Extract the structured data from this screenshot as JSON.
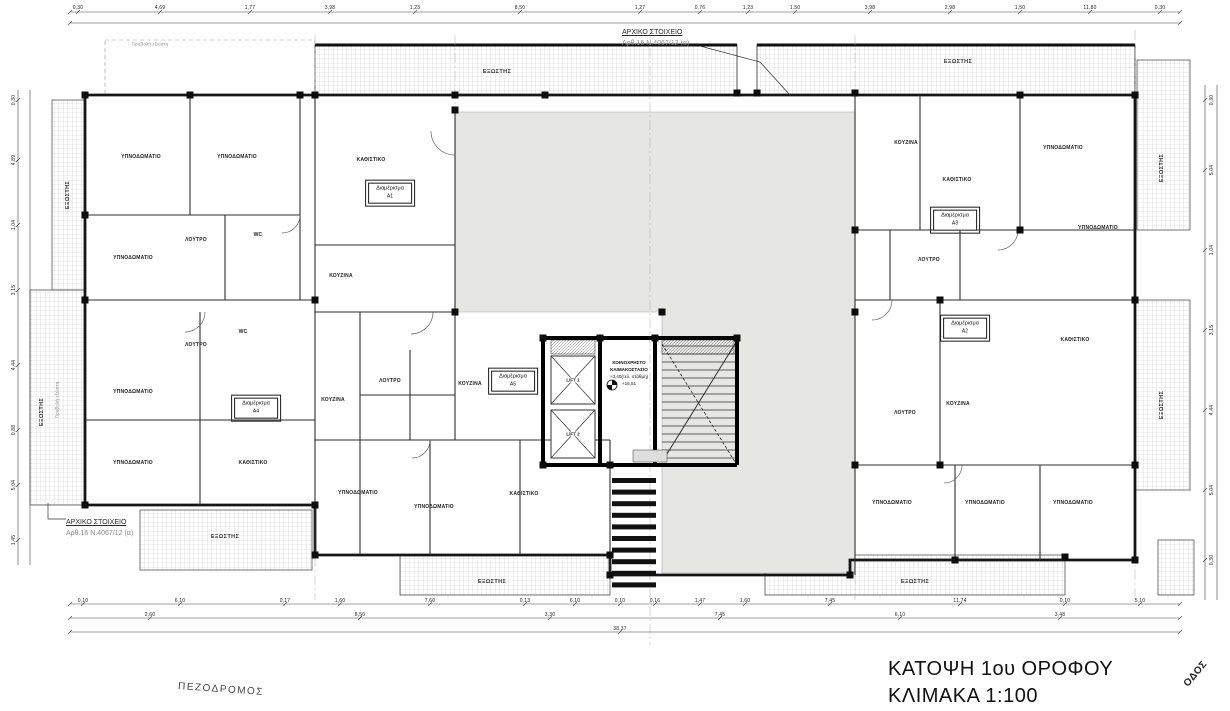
{
  "drawing": {
    "title_line1": "ΚΑΤΟΨΗ 1ου ΟΡΟΦΟΥ",
    "title_line2": "ΚΛΙΜΑΚΑ 1:100",
    "street_bottom": "ΠΕΖΟΔΡΟΜΟΣ",
    "street_right": "ΟΔΟΣ",
    "annotation_top": {
      "line1": "ΑΡΧΙΚΟ ΣΤΟΙΧΕΙΟ",
      "line2": "Αρθ.16  Ν.4067/12 (α)"
    },
    "annotation_bottom": {
      "line1": "ΑΡΧΙΚΟ ΣΤΟΙΧΕΙΟ",
      "line2": "Αρθ.16  Ν.4067/12 (α)"
    },
    "core": {
      "label_line1": "ΚΟΙΝΟΧΡΗΣΤΟ",
      "label_line2": "ΚΛΙΜΑΚΟΣΤΑΣΙΟ",
      "level1": "+3,40(τελ. στάθμη)",
      "level2": "+16,51",
      "lift1": "LIFT 1",
      "lift2": "LIFT 2"
    },
    "colors": {
      "void_gray": "#e6e6e3",
      "line": "#1a1a1a",
      "hatch": "#c9c9c9"
    }
  },
  "apartments": [
    {
      "name": "Διαμέρισμα",
      "number": "Α1",
      "x": 390,
      "y": 193
    },
    {
      "name": "Διαμέρισμα",
      "number": "Α3",
      "x": 955,
      "y": 220
    },
    {
      "name": "Διαμέρισμα",
      "number": "Α2",
      "x": 965,
      "y": 328
    },
    {
      "name": "Διαμέρισμα",
      "number": "Α4",
      "x": 256,
      "y": 408
    },
    {
      "name": "Διαμέρισμα",
      "number": "Α5",
      "x": 513,
      "y": 381
    }
  ],
  "rooms": [
    {
      "t": "ΥΠΝΟΔΩΜΑΤΙΟ",
      "x": 141,
      "y": 157
    },
    {
      "t": "ΥΠΝΟΔΩΜΑΤΙΟ",
      "x": 237,
      "y": 157
    },
    {
      "t": "ΥΠΝΟΔΩΜΑΤΙΟ",
      "x": 133,
      "y": 258
    },
    {
      "t": "ΚΑΘΙΣΤΙΚΟ",
      "x": 371,
      "y": 160
    },
    {
      "t": "ΚΟΥΖΙΝΑ",
      "x": 341,
      "y": 276
    },
    {
      "t": "ΛΟΥΤΡΟ",
      "x": 196,
      "y": 240
    },
    {
      "t": "WC",
      "x": 258,
      "y": 235
    },
    {
      "t": "ΛΟΥΤΡΟ",
      "x": 196,
      "y": 345
    },
    {
      "t": "WC",
      "x": 243,
      "y": 332
    },
    {
      "t": "ΥΠΝΟΔΩΜΑΤΙΟ",
      "x": 133,
      "y": 392
    },
    {
      "t": "ΥΠΝΟΔΩΜΑΤΙΟ",
      "x": 133,
      "y": 463
    },
    {
      "t": "ΚΑΘΙΣΤΙΚΟ",
      "x": 253,
      "y": 463
    },
    {
      "t": "ΚΟΥΖΙΝΑ",
      "x": 333,
      "y": 400
    },
    {
      "t": "ΛΟΥΤΡΟ",
      "x": 390,
      "y": 381
    },
    {
      "t": "ΚΟΥΖΙΝΑ",
      "x": 470,
      "y": 384
    },
    {
      "t": "ΥΠΝΟΔΩΜΑΤΙΟ",
      "x": 358,
      "y": 493
    },
    {
      "t": "ΥΠΝΟΔΩΜΑΤΙΟ",
      "x": 434,
      "y": 507
    },
    {
      "t": "ΚΑΘΙΣΤΙΚΟ",
      "x": 524,
      "y": 494
    },
    {
      "t": "ΚΟΥΖΙΝΑ",
      "x": 906,
      "y": 143
    },
    {
      "t": "ΚΑΘΙΣΤΙΚΟ",
      "x": 957,
      "y": 180
    },
    {
      "t": "ΥΠΝΟΔΩΜΑΤΙΟ",
      "x": 1063,
      "y": 148
    },
    {
      "t": "ΥΠΝΟΔΩΜΑΤΙΟ",
      "x": 1098,
      "y": 228
    },
    {
      "t": "ΛΟΥΤΡΟ",
      "x": 929,
      "y": 260
    },
    {
      "t": "ΚΑΘΙΣΤΙΚΟ",
      "x": 1075,
      "y": 340
    },
    {
      "t": "ΚΟΥΖΙΝΑ",
      "x": 958,
      "y": 404
    },
    {
      "t": "ΛΟΥΤΡΟ",
      "x": 905,
      "y": 413
    },
    {
      "t": "ΥΠΝΟΔΩΜΑΤΙΟ",
      "x": 892,
      "y": 503
    },
    {
      "t": "ΥΠΝΟΔΩΜΑΤΙΟ",
      "x": 985,
      "y": 503
    },
    {
      "t": "ΥΠΝΟΔΩΜΑΤΙΟ",
      "x": 1073,
      "y": 503
    }
  ],
  "balconies": [
    {
      "t": "ΕΞΩΣΤΗΣ",
      "x": 497,
      "y": 72
    },
    {
      "t": "ΕΞΩΣΤΗΣ",
      "x": 958,
      "y": 62
    },
    {
      "t": "ΕΞΩΣΤΗΣ",
      "x": 1162,
      "y": 168,
      "rot": -90
    },
    {
      "t": "ΕΞΩΣΤΗΣ",
      "x": 1162,
      "y": 405,
      "rot": -90
    },
    {
      "t": "ΕΞΩΣΤΗΣ",
      "x": 42,
      "y": 412,
      "rot": -90
    },
    {
      "t": "ΕΞΩΣΤΗΣ",
      "x": 68,
      "y": 195,
      "rot": -90
    },
    {
      "t": "ΕΞΩΣΤΗΣ",
      "x": 225,
      "y": 537
    },
    {
      "t": "ΕΞΩΣΤΗΣ",
      "x": 492,
      "y": 582
    },
    {
      "t": "ΕΞΩΣΤΗΣ",
      "x": 915,
      "y": 582
    }
  ],
  "misc_labels": [
    {
      "t": "Προβολή εξώστη",
      "x": 150,
      "y": 44
    },
    {
      "t": "Προβολή εξώστη",
      "x": 57,
      "y": 400,
      "rot": -90
    }
  ],
  "dimensions": [
    {
      "t": "0,30",
      "x": 78,
      "y": 8
    },
    {
      "t": "4,69",
      "x": 160,
      "y": 8
    },
    {
      "t": "1,77",
      "x": 250,
      "y": 8
    },
    {
      "t": "3,98",
      "x": 330,
      "y": 8
    },
    {
      "t": "1,23",
      "x": 415,
      "y": 8
    },
    {
      "t": "8,50",
      "x": 520,
      "y": 8
    },
    {
      "t": "1,27",
      "x": 640,
      "y": 8
    },
    {
      "t": "0,76",
      "x": 700,
      "y": 8
    },
    {
      "t": "1,23",
      "x": 748,
      "y": 8
    },
    {
      "t": "1,50",
      "x": 795,
      "y": 8
    },
    {
      "t": "3,98",
      "x": 870,
      "y": 8
    },
    {
      "t": "2,98",
      "x": 950,
      "y": 8
    },
    {
      "t": "1,50",
      "x": 1020,
      "y": 8
    },
    {
      "t": "11,80",
      "x": 1090,
      "y": 8
    },
    {
      "t": "0,30",
      "x": 1160,
      "y": 8
    },
    {
      "t": "0,10",
      "x": 83,
      "y": 601
    },
    {
      "t": "6,10",
      "x": 180,
      "y": 601
    },
    {
      "t": "0,17",
      "x": 285,
      "y": 601
    },
    {
      "t": "1,60",
      "x": 340,
      "y": 601
    },
    {
      "t": "7,60",
      "x": 430,
      "y": 601
    },
    {
      "t": "0,13",
      "x": 525,
      "y": 601
    },
    {
      "t": "6,10",
      "x": 575,
      "y": 601
    },
    {
      "t": "0,10",
      "x": 620,
      "y": 601
    },
    {
      "t": "0,16",
      "x": 655,
      "y": 601
    },
    {
      "t": "1,47",
      "x": 700,
      "y": 601
    },
    {
      "t": "1,60",
      "x": 745,
      "y": 601
    },
    {
      "t": "7,45",
      "x": 830,
      "y": 601
    },
    {
      "t": "11,74",
      "x": 960,
      "y": 601
    },
    {
      "t": "0,10",
      "x": 1065,
      "y": 601
    },
    {
      "t": "5,10",
      "x": 1140,
      "y": 601
    },
    {
      "t": "2,60",
      "x": 150,
      "y": 615
    },
    {
      "t": "8,50",
      "x": 360,
      "y": 615
    },
    {
      "t": "3,30",
      "x": 550,
      "y": 615
    },
    {
      "t": "7,45",
      "x": 720,
      "y": 615
    },
    {
      "t": "6,10",
      "x": 900,
      "y": 615
    },
    {
      "t": "3,48",
      "x": 1060,
      "y": 615
    },
    {
      "t": "38,37",
      "x": 620,
      "y": 629
    },
    {
      "t": "0,30",
      "x": 14,
      "y": 100,
      "rot": -90
    },
    {
      "t": "4,89",
      "x": 14,
      "y": 160,
      "rot": -90
    },
    {
      "t": "1,04",
      "x": 14,
      "y": 225,
      "rot": -90
    },
    {
      "t": "3,15",
      "x": 14,
      "y": 290,
      "rot": -90
    },
    {
      "t": "4,44",
      "x": 14,
      "y": 365,
      "rot": -90
    },
    {
      "t": "0,88",
      "x": 14,
      "y": 430,
      "rot": -90
    },
    {
      "t": "5,04",
      "x": 14,
      "y": 485,
      "rot": -90
    },
    {
      "t": "1,45",
      "x": 14,
      "y": 540,
      "rot": -90
    },
    {
      "t": "0,30",
      "x": 1212,
      "y": 100,
      "rot": -90
    },
    {
      "t": "5,04",
      "x": 1212,
      "y": 170,
      "rot": -90
    },
    {
      "t": "1,04",
      "x": 1212,
      "y": 250,
      "rot": -90
    },
    {
      "t": "3,15",
      "x": 1212,
      "y": 330,
      "rot": -90
    },
    {
      "t": "4,44",
      "x": 1212,
      "y": 410,
      "rot": -90
    },
    {
      "t": "5,04",
      "x": 1212,
      "y": 490,
      "rot": -90
    },
    {
      "t": "0,30",
      "x": 1212,
      "y": 560,
      "rot": -90
    }
  ]
}
